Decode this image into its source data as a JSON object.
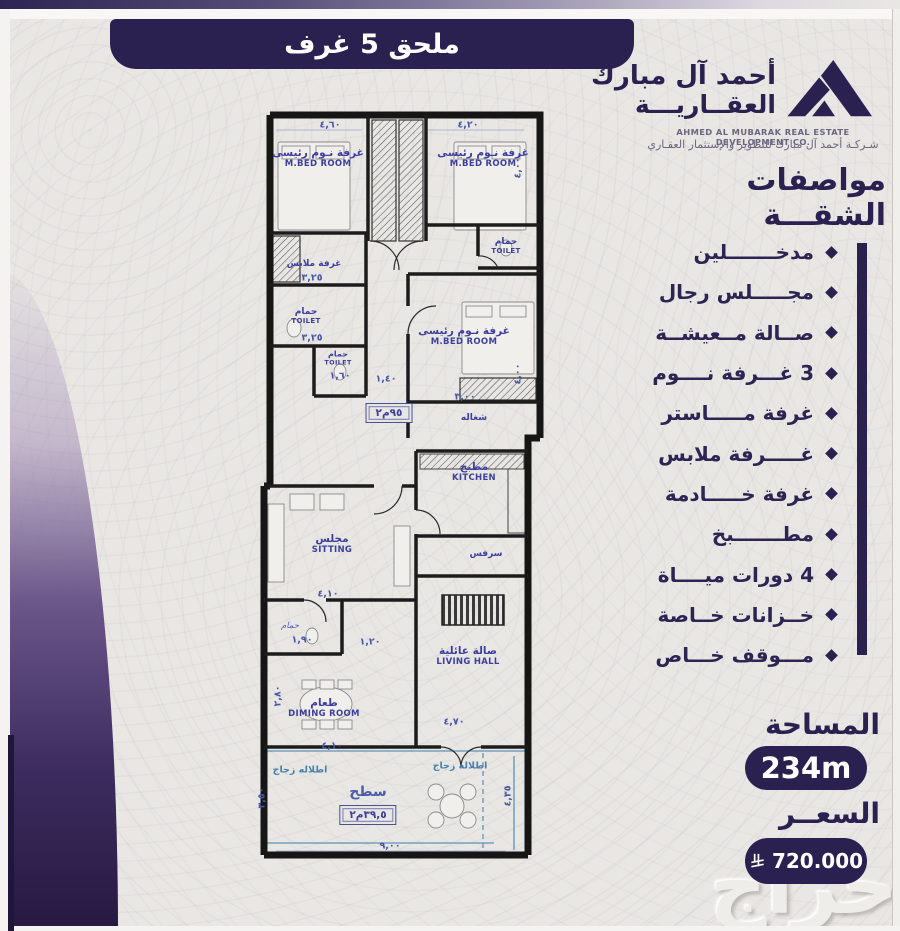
{
  "banner": {
    "title": "ملحق 5 غرف"
  },
  "logo": {
    "icon": "mountain-house-logo",
    "name_line1": "أحمد آل مبارك",
    "name_line2": "العقــاريـــة",
    "name_en": "AHMED AL MUBARAK REAL ESTATE DEVELOPMENT CO.",
    "tagline_ar": "شـركـة أحمد آل مبارك للتطوير والإستثمار العقـاري"
  },
  "specs": {
    "heading": "مواصفات الشقـــة",
    "items": [
      {
        "label": "مدخـــــــلين"
      },
      {
        "label": "مجـــــلس رجال"
      },
      {
        "label": "صــالة مــعيشــة"
      },
      {
        "label": "3 غـــرفة نــــوم"
      },
      {
        "label": "غرفة مـــــاستر"
      },
      {
        "label": "غـــــرفة ملابس"
      },
      {
        "label": "غرفة خـــــادمة"
      },
      {
        "label": "مطـــــــبخ"
      },
      {
        "label": "4 دورات ميــــاة"
      },
      {
        "label": "خــزانات خــاصة"
      },
      {
        "label": "مـــوقف خـــاص"
      }
    ]
  },
  "area": {
    "label": "المساحة",
    "value": "234m"
  },
  "price": {
    "label": "السعــر",
    "value": "720.000",
    "currency_icon": "saudi-riyal-symbol"
  },
  "watermark": "حراج",
  "colors": {
    "navy": "#2a2150",
    "plan_label_blue": "#3c3f9e",
    "dim_blue": "#4556a8",
    "glass_teal": "#4a7fae"
  },
  "plan": {
    "labels": [
      {
        "x": 62,
        "y": 52,
        "ar": "غرفة نـوم رئيسى",
        "en": "M.BED ROOM",
        "cls": "room"
      },
      {
        "x": 227,
        "y": 52,
        "ar": "غرفة نـوم رئيسى",
        "en": "M.BED ROOM",
        "cls": "room"
      },
      {
        "x": 250,
        "y": 140,
        "ar": "حمام",
        "en": "TOILET",
        "cls": "small"
      },
      {
        "x": 58,
        "y": 158,
        "ar": "غرفة ملابس",
        "cls": "small"
      },
      {
        "x": 50,
        "y": 210,
        "ar": "حمام",
        "en": "TOILET",
        "cls": "small"
      },
      {
        "x": 82,
        "y": 252,
        "ar": "حمام",
        "en": "TOILET",
        "cls": "tiny"
      },
      {
        "x": 208,
        "y": 230,
        "ar": "غرفة نـوم رئيسى",
        "en": "M.BED ROOM",
        "cls": "room"
      },
      {
        "x": 218,
        "y": 312,
        "ar": "شغاله",
        "cls": "small"
      },
      {
        "x": 218,
        "y": 366,
        "ar": "مطبخ",
        "en": "KITCHEN",
        "cls": "room"
      },
      {
        "x": 230,
        "y": 448,
        "ar": "سرفس",
        "cls": "small"
      },
      {
        "x": 76,
        "y": 438,
        "ar": "مجلس",
        "en": "SITTING",
        "cls": "room"
      },
      {
        "x": 212,
        "y": 550,
        "ar": "صالة عائلية",
        "en": "LIVING HALL",
        "cls": "room"
      },
      {
        "x": 68,
        "y": 602,
        "ar": "طعام",
        "en": "DIMING ROOM",
        "cls": "room"
      },
      {
        "x": 34,
        "y": 520,
        "ar": "حمام",
        "cls": "script"
      },
      {
        "x": 44,
        "y": 664,
        "ar": "اطلاله زجاج",
        "cls": "glass"
      },
      {
        "x": 204,
        "y": 660,
        "ar": "اطلاله زجاج",
        "cls": "glass"
      },
      {
        "x": 112,
        "y": 686,
        "ar": "سطح",
        "cls": "surface"
      }
    ],
    "boxes": [
      {
        "x": 133,
        "y": 307,
        "text": "٩٥م٢"
      },
      {
        "x": 112,
        "y": 709,
        "text": "٣٩,٥م٢"
      }
    ],
    "dims": [
      {
        "x": 74,
        "y": 19,
        "t": "٤,٦٠"
      },
      {
        "x": 212,
        "y": 19,
        "t": "٤,٢٠"
      },
      {
        "x": 262,
        "y": 62,
        "t": "٤,٠٠",
        "rot": true
      },
      {
        "x": 56,
        "y": 172,
        "t": "٣,٢٥"
      },
      {
        "x": 56,
        "y": 232,
        "t": "٣,٢٥"
      },
      {
        "x": 84,
        "y": 270,
        "t": "١,٦٠"
      },
      {
        "x": 130,
        "y": 273,
        "t": "١,٤٠"
      },
      {
        "x": 209,
        "y": 291,
        "t": "٣,٠٠"
      },
      {
        "x": 262,
        "y": 268,
        "t": "٤,٠٠",
        "rot": true
      },
      {
        "x": 72,
        "y": 488,
        "t": "٤,١٠"
      },
      {
        "x": 46,
        "y": 534,
        "t": "١,٩٠"
      },
      {
        "x": 114,
        "y": 536,
        "t": "١,٢٠"
      },
      {
        "x": 22,
        "y": 590,
        "t": "٢,٨٠",
        "rot": true
      },
      {
        "x": 198,
        "y": 616,
        "t": "٤,٧٠"
      },
      {
        "x": 76,
        "y": 640,
        "t": "٤,١٠"
      },
      {
        "x": 134,
        "y": 740,
        "t": "٩,٠٠"
      },
      {
        "x": 252,
        "y": 690,
        "t": "٤,٣٥",
        "rot": true
      },
      {
        "x": 6,
        "y": 692,
        "t": "٣,٥٠",
        "rot": true
      }
    ]
  }
}
